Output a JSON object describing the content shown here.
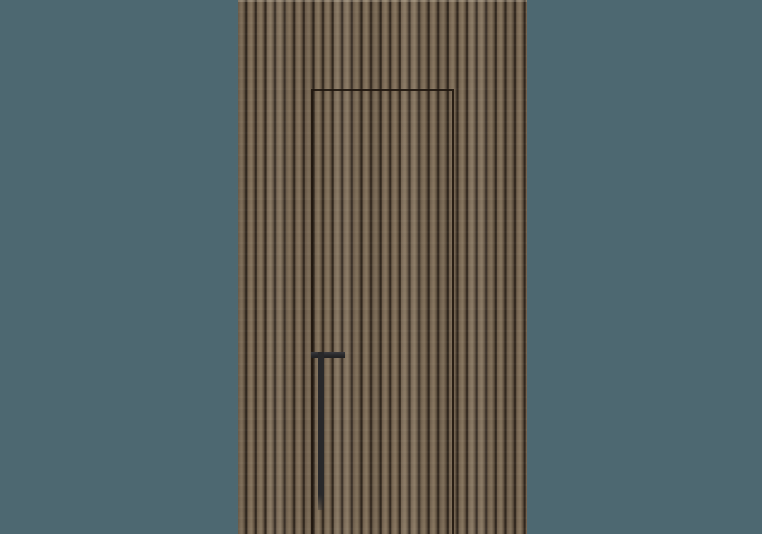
{
  "scene": {
    "description": "Product render of a vertical wood-slat wall panel with a concealed flush door outlined by a thin dark seam and a long vertical black pull handle, centered on a plain slate-teal background",
    "background": "slate-teal studio backdrop",
    "panel": {
      "description": "floor-to-ceiling walnut-tone vertical slat paneling",
      "slat_count_visible": 30
    },
    "door": {
      "description": "hidden flush door revealed only by a thin rectangular seam, open at the bottom edge of the crop"
    },
    "handle": {
      "description": "matte black L-profile pull: short horizontal cap with a long vertical grip bar descending toward the floor"
    }
  },
  "css_vars": {
    "--bg": "#4d6871",
    "--wood-light": "#82715c",
    "--wood-light2": "#87765f",
    "--wood-mid": "#6f5f4c",
    "--wood-shadow": "#574939",
    "--wood-shadow2": "#5d4f3e",
    "--wood-groove": "#32281f",
    "--seam": "rgba(30,21,13,0.9)",
    "--handle": "#28282a"
  },
  "colors": {
    "background": "#4d6871",
    "wood_light": "#87765f",
    "wood_mid": "#6f5f4c",
    "wood_groove": "#32281f",
    "door_seam": "#1e150d",
    "handle": "#28282a"
  }
}
